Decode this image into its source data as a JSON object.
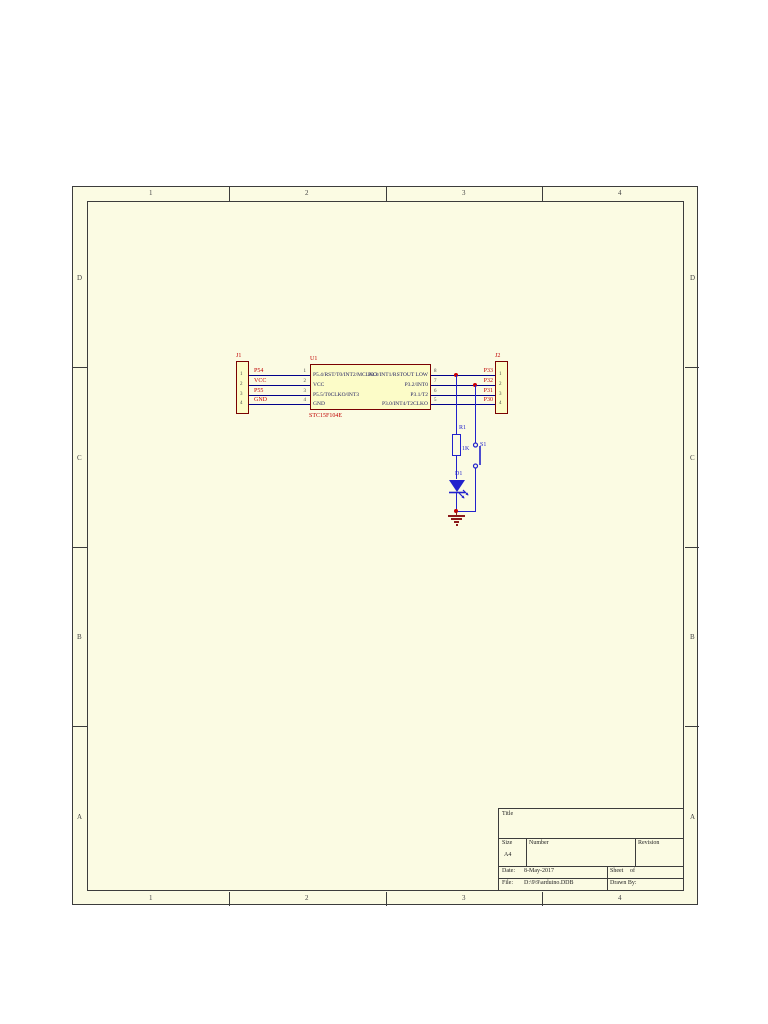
{
  "sheet": {
    "zones_top": [
      "1",
      "2",
      "3",
      "4"
    ],
    "zones_side": [
      "D",
      "C",
      "B",
      "A"
    ]
  },
  "schematic": {
    "j1": {
      "ref": "J1",
      "pins": [
        "1",
        "2",
        "3",
        "4"
      ],
      "nets": [
        "P54",
        "VCC",
        "P55",
        "GND"
      ]
    },
    "u1": {
      "ref": "U1",
      "part": "STC15F104E",
      "left_pins": [
        {
          "num": "1",
          "name": "P5.4/RST/T0/INT2/MCLKO"
        },
        {
          "num": "2",
          "name": "VCC"
        },
        {
          "num": "3",
          "name": "P5.5/T0CLKO/INT3"
        },
        {
          "num": "4",
          "name": "GND"
        }
      ],
      "right_pins": [
        {
          "num": "8",
          "name": "P3.3/INT1/RSTOUT LOW"
        },
        {
          "num": "7",
          "name": "P3.2/INT0"
        },
        {
          "num": "6",
          "name": "P3.1/T2"
        },
        {
          "num": "5",
          "name": "P3.0/INT4/T2CLKO"
        }
      ]
    },
    "j2": {
      "ref": "J2",
      "pins": [
        "1",
        "2",
        "3",
        "4"
      ],
      "nets": [
        "P33",
        "P32",
        "P31",
        "P30"
      ]
    },
    "r1": {
      "ref": "R1",
      "value": "1K"
    },
    "s1": {
      "ref": "S1"
    },
    "d1": {
      "ref": "D1"
    }
  },
  "title_block": {
    "title_label": "Title",
    "size_label": "Size",
    "size_value": "A4",
    "number_label": "Number",
    "revision_label": "Revision",
    "date_label": "Date:",
    "date_value": "8-May-2017",
    "sheet_label": "Sheet",
    "of_label": "of",
    "file_label": "File:",
    "file_value": "D:\\9\\9\\arduino.DDB",
    "drawn_by_label": "Drawn By:"
  },
  "colors": {
    "sheet_bg": "#FBFBE3",
    "component_fill": "#FCFCC8",
    "component_border": "#7A0101",
    "wire": "#00008B",
    "symbol_blue": "#2222CC",
    "net_label_red": "#C00000",
    "ground_red": "#8B1A1A"
  }
}
